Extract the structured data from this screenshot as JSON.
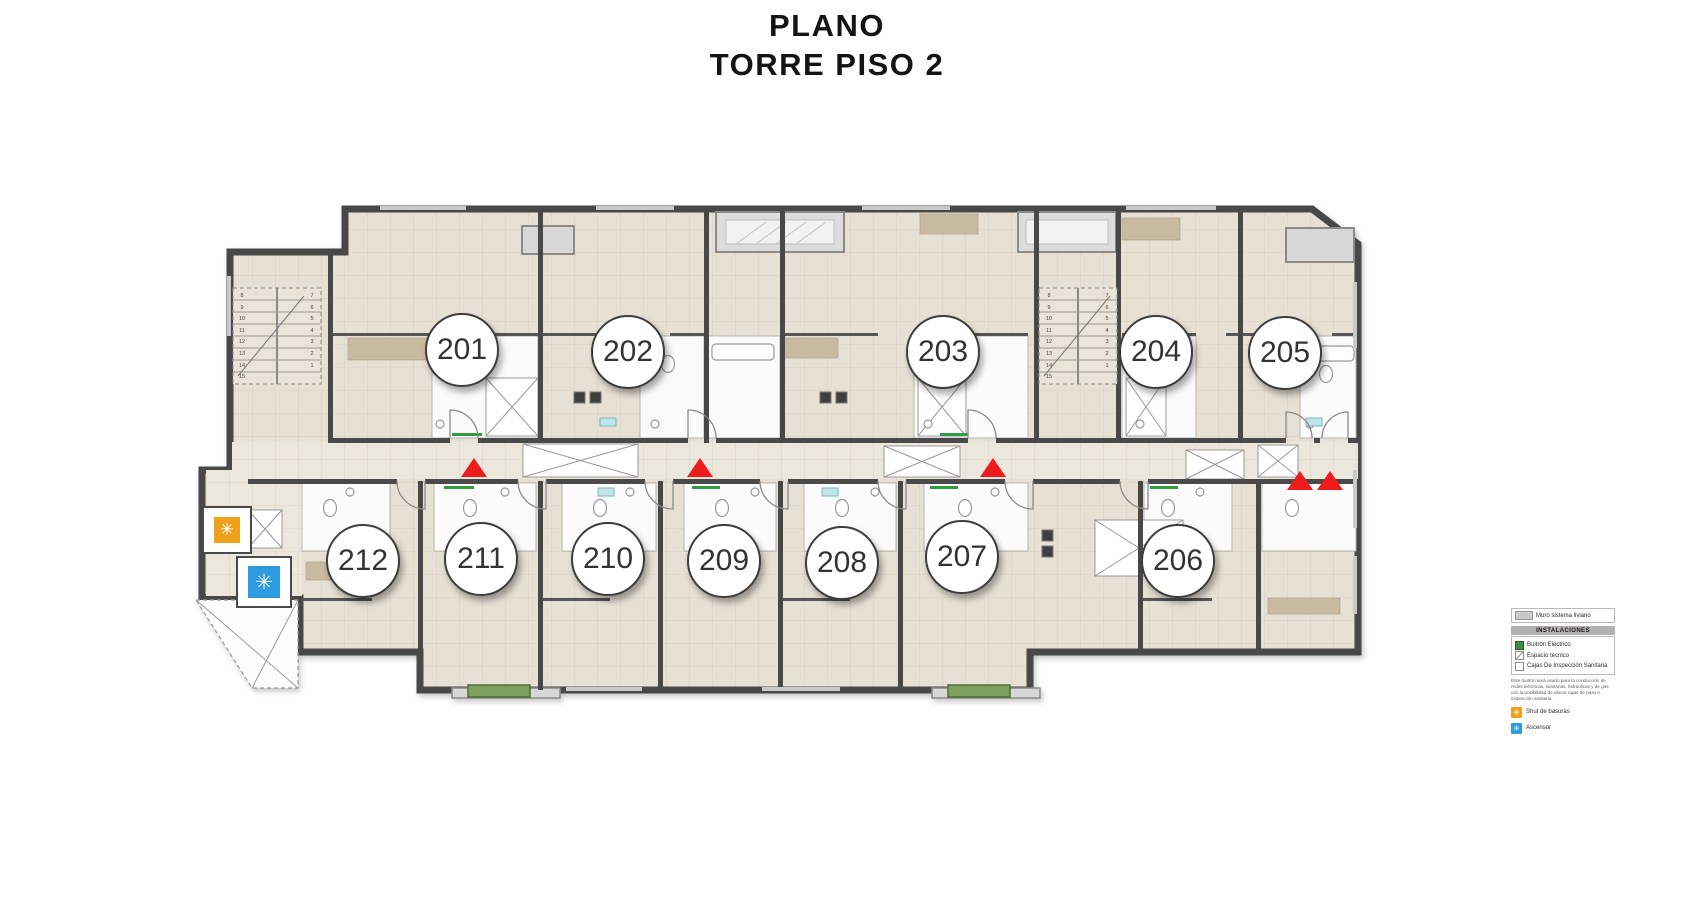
{
  "title": {
    "line1": "PLANO",
    "line2": "TORRE PISO 2"
  },
  "units": [
    {
      "number": "201"
    },
    {
      "number": "202"
    },
    {
      "number": "203"
    },
    {
      "number": "204"
    },
    {
      "number": "205"
    },
    {
      "number": "206"
    },
    {
      "number": "207"
    },
    {
      "number": "208"
    },
    {
      "number": "209"
    },
    {
      "number": "210"
    },
    {
      "number": "211"
    },
    {
      "number": "212"
    }
  ],
  "plan": {
    "stairs_left": {
      "col_a": "8\n9\n10\n11\n12\n13\n14\n15",
      "col_b": "7\n6\n5\n4\n3\n2\n1"
    },
    "stairs_right": {
      "col_a": "8\n9\n10\n11\n12\n13\n14\n15",
      "col_b": "7\n6\n5\n4\n3\n2\n1"
    },
    "entrance_marker_color": "#EE1C1C"
  },
  "facilities": {
    "trash_chute": {
      "symbol": "✳",
      "color": "#F0A11C"
    },
    "elevator": {
      "symbol": "✳",
      "color": "#2D9BE0"
    }
  },
  "legend": {
    "wall_item_label": "Muro sistema liviano",
    "header": "INSTALACIONES",
    "items": [
      {
        "label": "Buitrón Eléctrico",
        "color": "#3E8E41"
      },
      {
        "label": "Espacio técnico",
        "color": "hatch"
      },
      {
        "label": "Cajas De Inspección Sanitaria",
        "color": "#FFFFFF"
      }
    ],
    "note": "Este buitrón será usado para la conducción de redes eléctricas, sanitarias, hidráulicas y de gas con la posibilidad de ubicar cajas de paso e inspección sanitaria.",
    "icon_items": [
      {
        "label": "Shut de basuras",
        "symbol": "✳"
      },
      {
        "label": "Ascensor",
        "symbol": "✳"
      }
    ]
  },
  "colors": {
    "wall_dark": "#484848",
    "floor_beige": "#E7E1D5",
    "marker_red": "#EE1C1C",
    "buitron_green": "#3E8E41"
  }
}
